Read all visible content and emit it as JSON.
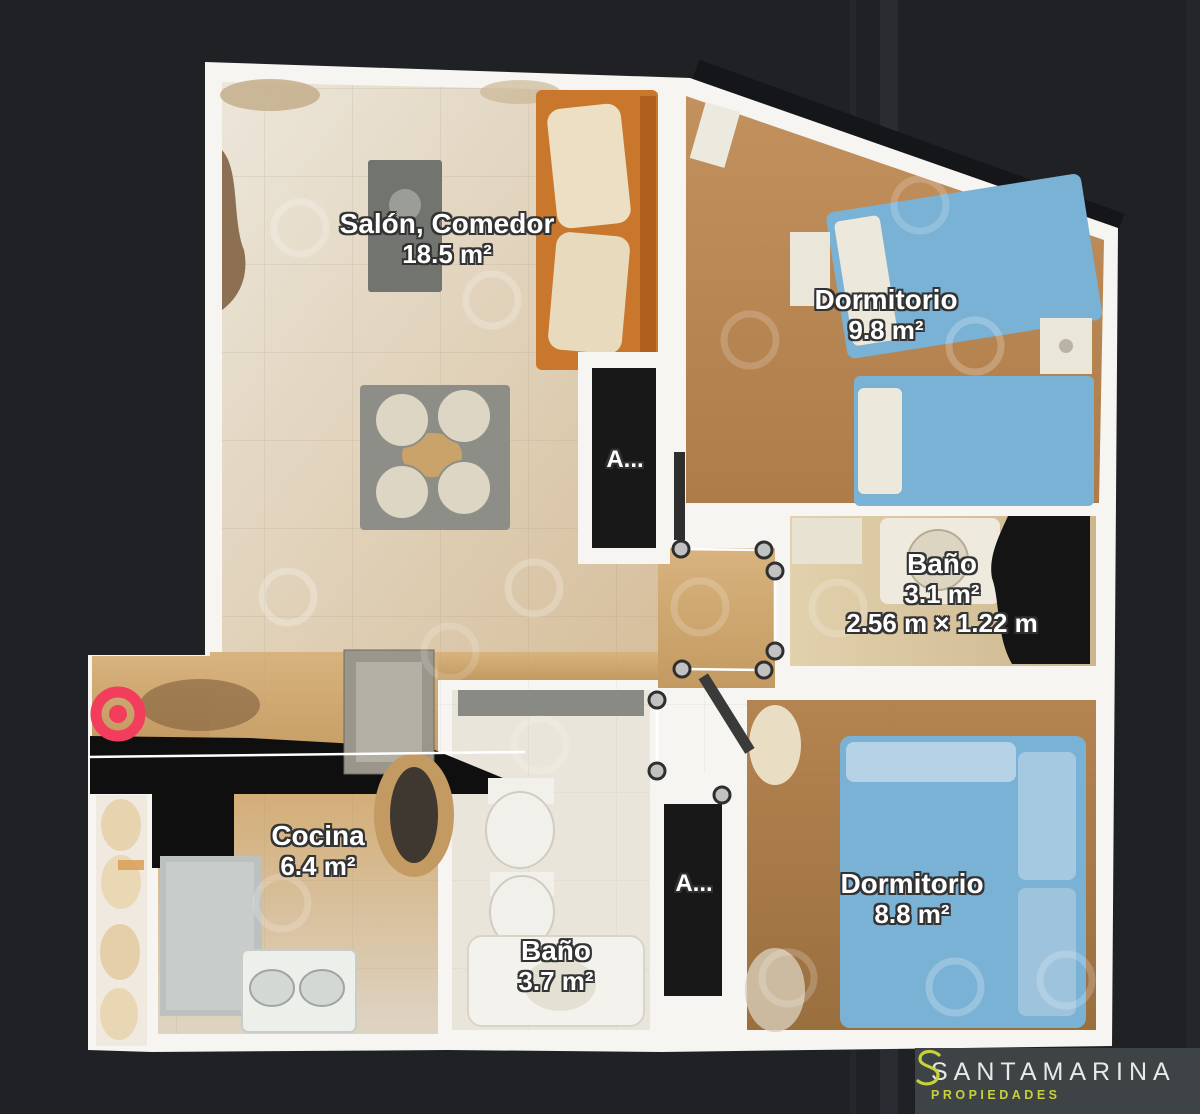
{
  "plan": {
    "rooms": [
      {
        "name": "Salón, Comedor",
        "area": "18.5 m²"
      },
      {
        "name": "Dormitorio",
        "area": "9.8 m²"
      },
      {
        "name": "Baño",
        "area": "3.1 m²",
        "dimensions": "2.56 m × 1.22 m"
      },
      {
        "name": "Cocina",
        "area": "6.4 m²"
      },
      {
        "name": "Baño",
        "area": "3.7 m²"
      },
      {
        "name": "Dormitorio",
        "area": "8.8 m²"
      }
    ],
    "closets": [
      {
        "label": "A..."
      },
      {
        "label": "A..."
      }
    ],
    "start_marker_color": "#f23e5c",
    "wall_color": "#f7f5f1",
    "bed_color": "#79b1d6"
  },
  "logo": {
    "brand": "SANTAMARINA",
    "tagline": "PROPIEDADES",
    "accent_color": "#c7d13b",
    "brand_color": "#e6e9e8",
    "box_color": "#3e4345"
  }
}
